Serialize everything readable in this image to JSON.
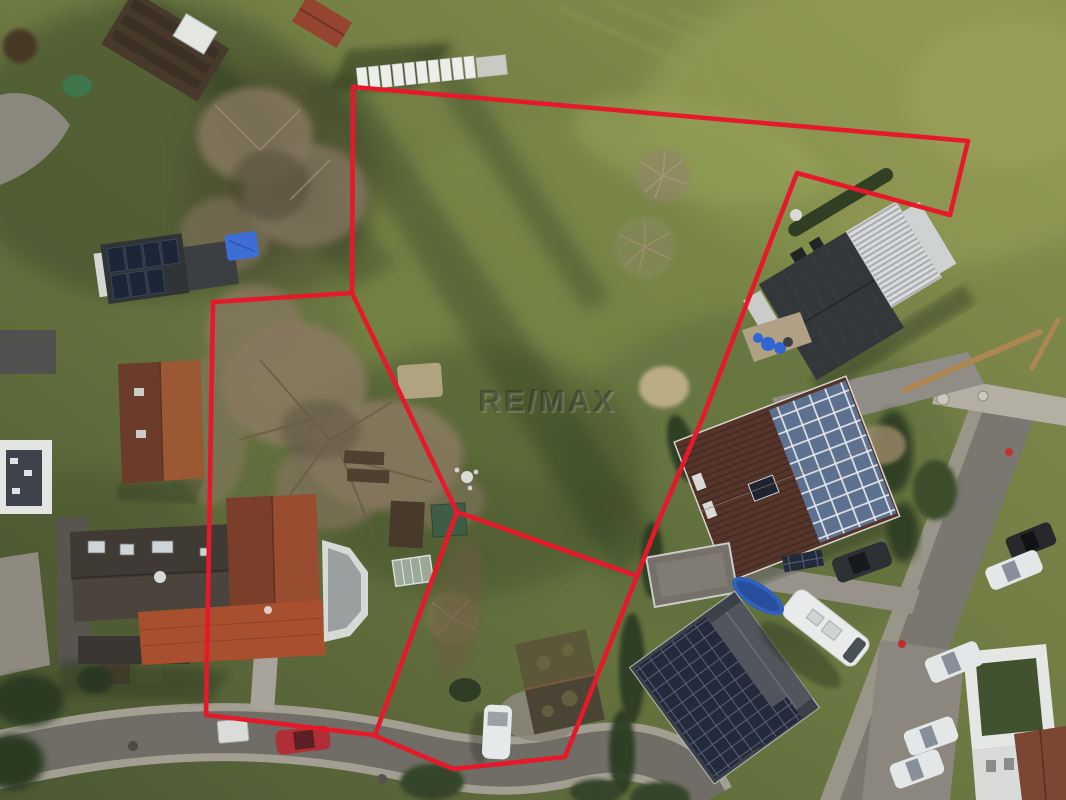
{
  "meta": {
    "description": "aerial-drone-photo-of-property-with-boundary-overlay",
    "watermark": "RE/MAX"
  },
  "boundary": {
    "color": "#e6192b",
    "stroke_width": 4.6,
    "outer_polygon": "353,87 968,141 950,215 797,173 703,417 659,520 637,576 565,757 453,769 373,735 206,715 213,302 352,293",
    "inner_lines": [
      "352,293 457,512",
      "457,512 375,735",
      "457,512 637,576"
    ]
  },
  "palette": {
    "grass_light": "#8a9150",
    "grass_mid": "#6d7a42",
    "grass_dark": "#4c5833",
    "road": "#6f6d65",
    "roof_red": "#8a452f",
    "roof_dark": "#33373a",
    "solar_blue": "#5f7292",
    "watermark_fill": "rgba(40,42,36,0.42)"
  }
}
